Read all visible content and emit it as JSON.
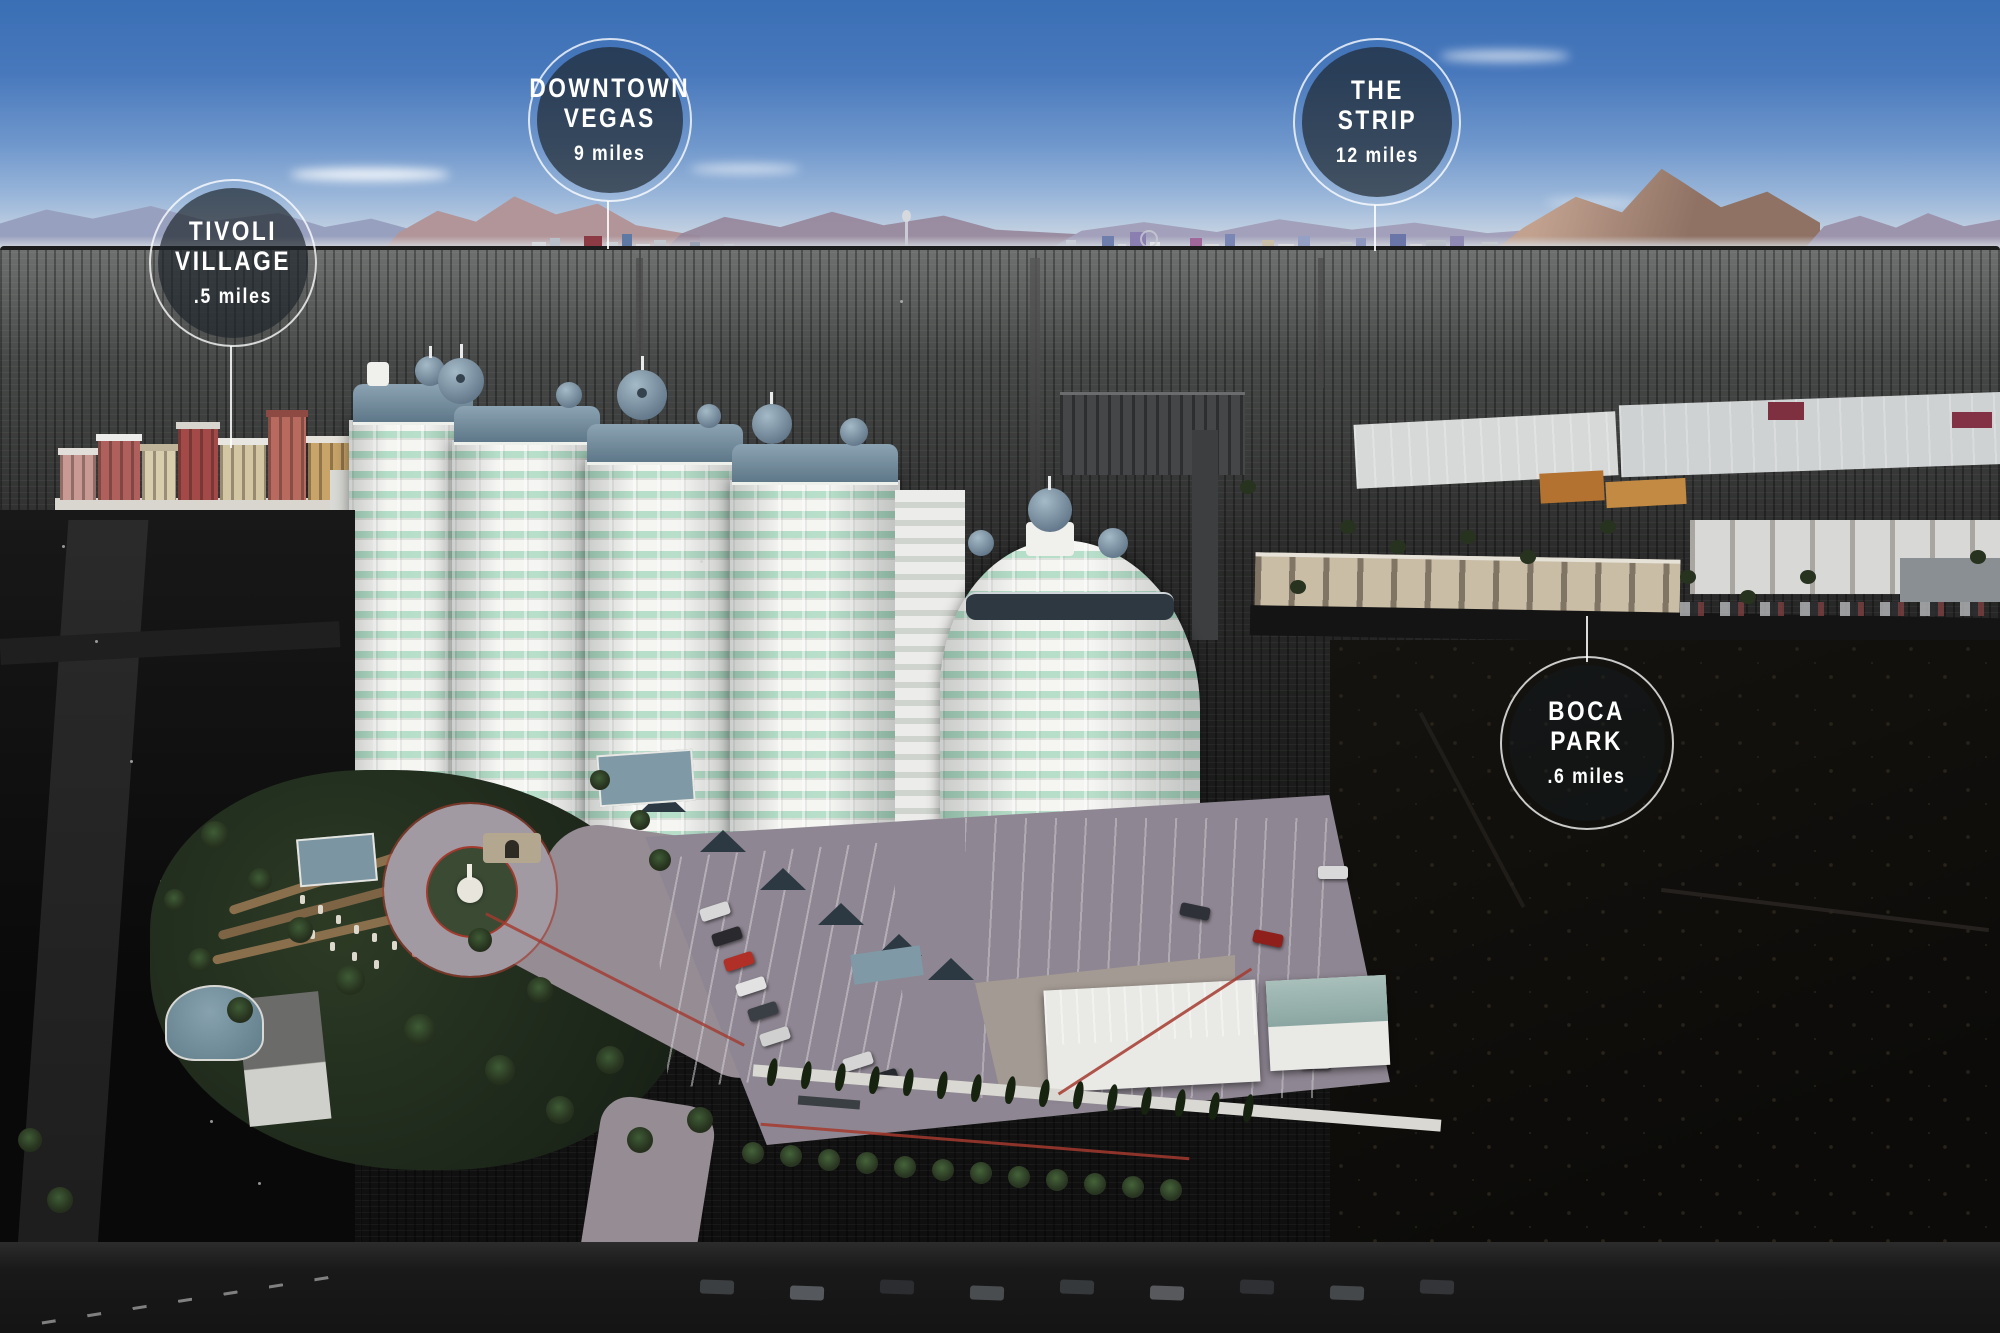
{
  "badges": [
    {
      "id": "tivoli-village",
      "line1": "TIVOLI",
      "line2": "VILLAGE",
      "distance": ".5 miles"
    },
    {
      "id": "downtown-vegas",
      "line1": "DOWNTOWN",
      "line2": "VEGAS",
      "distance": "9 miles"
    },
    {
      "id": "the-strip",
      "line1": "THE",
      "line2": "STRIP",
      "distance": "12 miles"
    },
    {
      "id": "boca-park",
      "line1": "BOCA",
      "line2": "PARK",
      "distance": ".6 miles"
    }
  ],
  "colors": {
    "badge_fill": "rgba(28,36,42,0.68)",
    "badge_ring": "#ffffff",
    "sky_top": "#3a6fb5",
    "tower_window_teal": "#a9d8bf",
    "roof_slate": "#6d8698",
    "drive_mauve": "#968c94",
    "curb_red": "#a43a2e"
  }
}
